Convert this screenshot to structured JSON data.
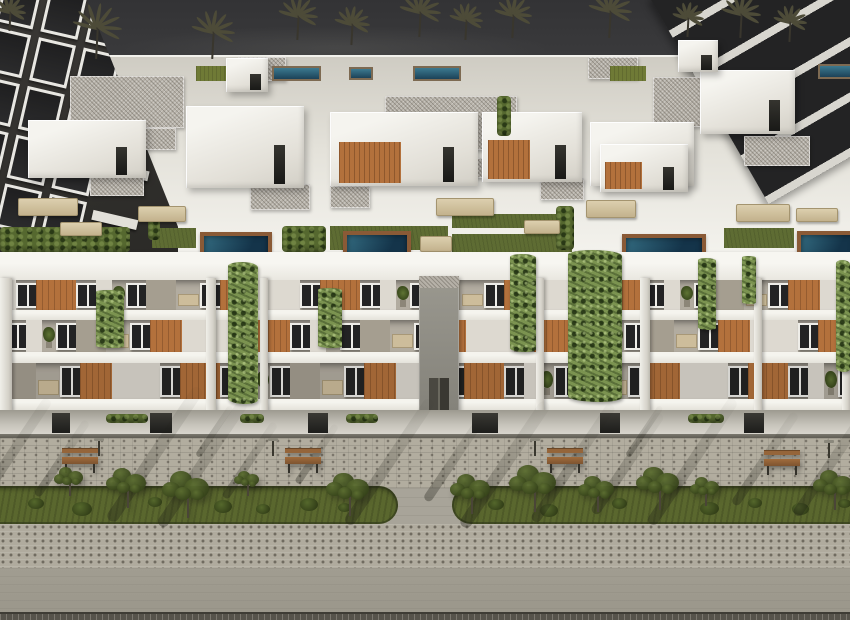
{
  "scene": {
    "kind": "3d-architectural-render",
    "subject": "Aerial view of a modern white low-rise apartment complex with rooftop terraces, plunge pools, wooden balcony accent walls, climbing vines, palm trees against a dark sky, and a landscaped pedestrian promenade with benches and trees"
  },
  "palette": {
    "sky_top": "#333335",
    "sky_bottom": "#454543",
    "palm": "#4d4b38",
    "dark_building": "#34322f",
    "dark_glass": "#232324",
    "white_bright": "#f5f4ef",
    "white_mid": "#e4e2da",
    "white_dim": "#cfccc3",
    "gravel": "#b6b1a8",
    "green_roof": "#6f7a36",
    "turf": "#5e6c33",
    "hedge": "#55682f",
    "vine": "#7b9350",
    "pool_light": "#2e6277",
    "pool_dark": "#14344a",
    "pool_deck": "#8a5a36",
    "wood": "#b3713c",
    "window_frame": "#eeede8",
    "wall_recess": "#b2aca0",
    "slab": "#f0efe8",
    "ground_wall": "#c6c3ba",
    "curb": "#5f5c54",
    "pave_sidewalk": "#b2ad9f",
    "pave_mid": "#a8a499",
    "pave_dot": "#b0ab9e",
    "pave_low": "#a19d91",
    "pave_bottom": "#56534b",
    "grass": "#5a672e",
    "bush": "#41511f",
    "tree_green": "#4c5c28",
    "trunk": "#4a4537",
    "bench_wood": "#95653a",
    "shadow": "rgba(28,28,20,0.34)"
  },
  "sky": {
    "palms": [
      {
        "x": 10,
        "y": 10,
        "s": 0.8
      },
      {
        "x": 97,
        "y": 26,
        "s": 1.25
      },
      {
        "x": 213,
        "y": 30,
        "s": 1.1
      },
      {
        "x": 298,
        "y": 14,
        "s": 1.0
      },
      {
        "x": 352,
        "y": 22,
        "s": 0.9
      },
      {
        "x": 420,
        "y": 10,
        "s": 1.05
      },
      {
        "x": 466,
        "y": 18,
        "s": 0.85
      },
      {
        "x": 513,
        "y": 13,
        "s": 0.95
      },
      {
        "x": 610,
        "y": 9,
        "s": 1.1
      },
      {
        "x": 688,
        "y": 16,
        "s": 0.8
      },
      {
        "x": 741,
        "y": 12,
        "s": 1.0
      },
      {
        "x": 790,
        "y": 20,
        "s": 0.85
      }
    ]
  },
  "background": {
    "left_building": {
      "rows": 5,
      "cols": 3
    },
    "right_building": {
      "stripes": 4
    }
  },
  "rooftop": {
    "gravel": [
      {
        "x": 70,
        "y": 76,
        "w": 114,
        "h": 52
      },
      {
        "x": 385,
        "y": 96,
        "w": 132,
        "h": 54
      },
      {
        "x": 653,
        "y": 77,
        "w": 140,
        "h": 50
      },
      {
        "x": 238,
        "y": 57,
        "w": 48,
        "h": 24
      },
      {
        "x": 588,
        "y": 57,
        "w": 50,
        "h": 22
      },
      {
        "x": 90,
        "y": 168,
        "w": 54,
        "h": 28
      },
      {
        "x": 250,
        "y": 184,
        "w": 60,
        "h": 26
      },
      {
        "x": 540,
        "y": 178,
        "w": 44,
        "h": 22
      },
      {
        "x": 744,
        "y": 136,
        "w": 66,
        "h": 30
      },
      {
        "x": 132,
        "y": 128,
        "w": 44,
        "h": 22
      },
      {
        "x": 470,
        "y": 158,
        "w": 40,
        "h": 20
      },
      {
        "x": 330,
        "y": 186,
        "w": 40,
        "h": 22
      }
    ],
    "green_roofs": [
      {
        "x": 196,
        "y": 66,
        "w": 36,
        "h": 15
      },
      {
        "x": 610,
        "y": 66,
        "w": 36,
        "h": 15
      }
    ],
    "lap_pools": [
      {
        "x": 272,
        "y": 66,
        "w": 45,
        "h": 11
      },
      {
        "x": 349,
        "y": 67,
        "w": 20,
        "h": 9
      },
      {
        "x": 413,
        "y": 66,
        "w": 44,
        "h": 11
      },
      {
        "x": 818,
        "y": 64,
        "w": 32,
        "h": 11
      }
    ],
    "penthouses": [
      {
        "x": 28,
        "y": 120,
        "w": 118,
        "h": 58,
        "wood": false
      },
      {
        "x": 186,
        "y": 106,
        "w": 118,
        "h": 82,
        "wood": false
      },
      {
        "x": 330,
        "y": 112,
        "w": 148,
        "h": 74,
        "wood": true
      },
      {
        "x": 482,
        "y": 112,
        "w": 100,
        "h": 70,
        "wood": true
      },
      {
        "x": 590,
        "y": 122,
        "w": 104,
        "h": 64,
        "wood": false
      },
      {
        "x": 700,
        "y": 70,
        "w": 95,
        "h": 64,
        "wood": false
      },
      {
        "x": 600,
        "y": 144,
        "w": 88,
        "h": 48,
        "wood": true
      },
      {
        "x": 226,
        "y": 58,
        "w": 42,
        "h": 34,
        "wood": false
      },
      {
        "x": 678,
        "y": 40,
        "w": 40,
        "h": 32,
        "wood": false
      }
    ],
    "turf": [
      {
        "x": 330,
        "y": 226,
        "w": 118,
        "h": 24
      },
      {
        "x": 452,
        "y": 214,
        "w": 108,
        "h": 14
      },
      {
        "x": 452,
        "y": 234,
        "w": 120,
        "h": 18
      },
      {
        "x": 724,
        "y": 228,
        "w": 70,
        "h": 20
      },
      {
        "x": 152,
        "y": 228,
        "w": 44,
        "h": 20
      }
    ],
    "hedges": [
      {
        "x": 0,
        "y": 227,
        "w": 130,
        "h": 25
      },
      {
        "x": 282,
        "y": 226,
        "w": 44,
        "h": 26
      },
      {
        "x": 497,
        "y": 96,
        "w": 14,
        "h": 40
      },
      {
        "x": 556,
        "y": 206,
        "w": 18,
        "h": 44
      },
      {
        "x": 148,
        "y": 210,
        "w": 12,
        "h": 30
      }
    ],
    "furniture": [
      {
        "x": 18,
        "y": 198,
        "w": 58,
        "h": 16
      },
      {
        "x": 138,
        "y": 206,
        "w": 46,
        "h": 14
      },
      {
        "x": 436,
        "y": 198,
        "w": 56,
        "h": 16
      },
      {
        "x": 586,
        "y": 200,
        "w": 48,
        "h": 16
      },
      {
        "x": 736,
        "y": 204,
        "w": 52,
        "h": 16
      },
      {
        "x": 60,
        "y": 222,
        "w": 40,
        "h": 12
      },
      {
        "x": 420,
        "y": 236,
        "w": 30,
        "h": 14
      },
      {
        "x": 524,
        "y": 220,
        "w": 34,
        "h": 12
      },
      {
        "x": 796,
        "y": 208,
        "w": 40,
        "h": 12
      }
    ],
    "terrace_pools": [
      {
        "x": 200,
        "y": 232,
        "w": 64,
        "h": 23
      },
      {
        "x": 343,
        "y": 231,
        "w": 60,
        "h": 25
      },
      {
        "x": 622,
        "y": 234,
        "w": 76,
        "h": 21
      },
      {
        "x": 797,
        "y": 231,
        "w": 53,
        "h": 22
      }
    ]
  },
  "facade": {
    "floors": [
      {
        "y": 0,
        "h": 30
      },
      {
        "y": 40,
        "h": 32
      },
      {
        "y": 83,
        "h": 36
      }
    ],
    "offsets": [
      -10,
      -80,
      -150
    ],
    "pattern": [
      {
        "k": "white",
        "w": 26
      },
      {
        "k": "window",
        "w": 20
      },
      {
        "k": "wood",
        "w": 40
      },
      {
        "k": "window",
        "w": 20
      },
      {
        "k": "white",
        "w": 16
      },
      {
        "k": "plant",
        "w": 14
      },
      {
        "k": "window",
        "w": 20
      },
      {
        "k": "grey",
        "w": 30
      },
      {
        "k": "table",
        "w": 24
      },
      {
        "k": "window",
        "w": 20
      },
      {
        "k": "wood",
        "w": 32
      },
      {
        "k": "white",
        "w": 22
      }
    ],
    "piers": [
      {
        "x": 0,
        "w": 12
      },
      {
        "x": 206,
        "w": 10
      },
      {
        "x": 260,
        "w": 8
      },
      {
        "x": 536,
        "w": 8
      },
      {
        "x": 640,
        "w": 10
      },
      {
        "x": 754,
        "w": 8
      },
      {
        "x": 842,
        "w": 8
      }
    ],
    "tower": {
      "x": 419,
      "w": 40
    },
    "vines": [
      {
        "x": 228,
        "y": 262,
        "w": 30,
        "h": 142
      },
      {
        "x": 510,
        "y": 254,
        "w": 26,
        "h": 98
      },
      {
        "x": 568,
        "y": 250,
        "w": 54,
        "h": 152
      },
      {
        "x": 698,
        "y": 258,
        "w": 18,
        "h": 72
      },
      {
        "x": 836,
        "y": 260,
        "w": 14,
        "h": 112
      },
      {
        "x": 96,
        "y": 290,
        "w": 28,
        "h": 58
      },
      {
        "x": 318,
        "y": 288,
        "w": 24,
        "h": 60
      },
      {
        "x": 742,
        "y": 256,
        "w": 14,
        "h": 48
      }
    ]
  },
  "ground": {
    "doors": [
      {
        "x": 52,
        "w": 18
      },
      {
        "x": 150,
        "w": 22
      },
      {
        "x": 308,
        "w": 20
      },
      {
        "x": 472,
        "w": 26
      },
      {
        "x": 600,
        "w": 20
      },
      {
        "x": 744,
        "w": 20
      }
    ],
    "hedges": [
      {
        "x": 106,
        "w": 42
      },
      {
        "x": 240,
        "w": 24
      },
      {
        "x": 346,
        "w": 32
      },
      {
        "x": 688,
        "w": 36
      }
    ]
  },
  "street": {
    "islands": [
      {
        "x": -20,
        "w": 418,
        "round": "right"
      },
      {
        "x": 452,
        "w": 420,
        "round": "left"
      }
    ],
    "bushes": [
      {
        "x": 28,
        "y": 498,
        "s": 16
      },
      {
        "x": 72,
        "y": 502,
        "s": 20
      },
      {
        "x": 148,
        "y": 497,
        "s": 14
      },
      {
        "x": 214,
        "y": 500,
        "s": 18
      },
      {
        "x": 256,
        "y": 504,
        "s": 14
      },
      {
        "x": 300,
        "y": 498,
        "s": 18
      },
      {
        "x": 338,
        "y": 503,
        "s": 13
      },
      {
        "x": 488,
        "y": 499,
        "s": 16
      },
      {
        "x": 540,
        "y": 504,
        "s": 18
      },
      {
        "x": 612,
        "y": 498,
        "s": 15
      },
      {
        "x": 700,
        "y": 502,
        "s": 19
      },
      {
        "x": 748,
        "y": 498,
        "s": 14
      },
      {
        "x": 792,
        "y": 503,
        "s": 17
      },
      {
        "x": 838,
        "y": 499,
        "s": 13
      }
    ],
    "shadows": [
      {
        "x": -20,
        "y": 500,
        "len": 130,
        "w": 10
      },
      {
        "x": 40,
        "y": 490,
        "len": 90,
        "w": 8
      },
      {
        "x": 115,
        "y": 512,
        "len": 160,
        "w": 12
      },
      {
        "x": 165,
        "y": 518,
        "len": 150,
        "w": 11
      },
      {
        "x": 228,
        "y": 492,
        "len": 90,
        "w": 8
      },
      {
        "x": 300,
        "y": 478,
        "len": 70,
        "w": 7
      },
      {
        "x": 352,
        "y": 516,
        "len": 150,
        "w": 11
      },
      {
        "x": 430,
        "y": 494,
        "len": 100,
        "w": 9
      },
      {
        "x": 468,
        "y": 518,
        "len": 150,
        "w": 12
      },
      {
        "x": 538,
        "y": 514,
        "len": 140,
        "w": 10
      },
      {
        "x": 598,
        "y": 506,
        "len": 120,
        "w": 10
      },
      {
        "x": 655,
        "y": 516,
        "len": 150,
        "w": 11
      },
      {
        "x": 738,
        "y": 498,
        "len": 110,
        "w": 9
      },
      {
        "x": 800,
        "y": 508,
        "len": 130,
        "w": 10
      },
      {
        "x": 630,
        "y": 452,
        "len": 60,
        "w": 6
      },
      {
        "x": 200,
        "y": 452,
        "len": 60,
        "w": 6
      }
    ],
    "benches": [
      {
        "x": 62,
        "y": 448
      },
      {
        "x": 285,
        "y": 448
      },
      {
        "x": 547,
        "y": 448
      },
      {
        "x": 764,
        "y": 450
      }
    ],
    "lamps": [
      {
        "x": 94,
        "y": 438
      },
      {
        "x": 268,
        "y": 438
      },
      {
        "x": 530,
        "y": 438
      },
      {
        "x": 824,
        "y": 440
      }
    ],
    "trees": [
      {
        "x": 70,
        "y": 480,
        "s": 0.8
      },
      {
        "x": 128,
        "y": 486,
        "s": 1.1
      },
      {
        "x": 188,
        "y": 492,
        "s": 1.3
      },
      {
        "x": 248,
        "y": 482,
        "s": 0.7
      },
      {
        "x": 350,
        "y": 492,
        "s": 1.2
      },
      {
        "x": 472,
        "y": 492,
        "s": 1.1
      },
      {
        "x": 535,
        "y": 486,
        "s": 1.3
      },
      {
        "x": 598,
        "y": 492,
        "s": 1.0
      },
      {
        "x": 660,
        "y": 486,
        "s": 1.2
      },
      {
        "x": 706,
        "y": 490,
        "s": 0.8
      },
      {
        "x": 835,
        "y": 488,
        "s": 1.1
      }
    ]
  }
}
